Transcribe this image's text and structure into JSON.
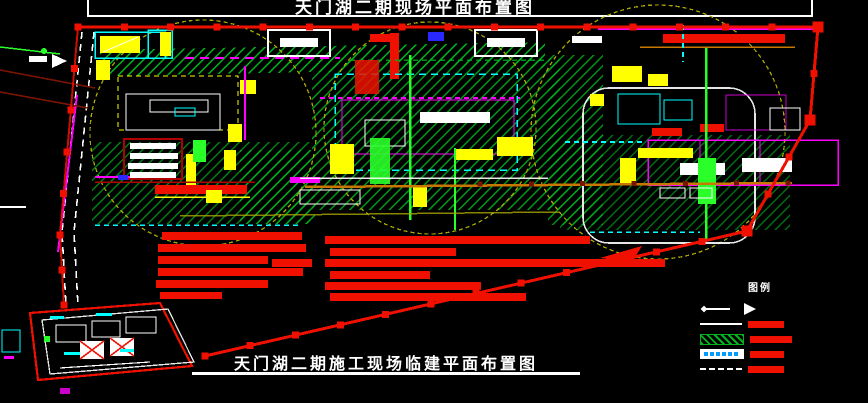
{
  "titles": {
    "top": "天门湖二期现场平面布置图",
    "bottom": "天门湖二期施工现场临建平面布置图"
  },
  "legend": {
    "label": "图例",
    "items": [
      {
        "symbol": "direction-arrow"
      },
      {
        "symbol": "solid-line",
        "swatch": "red-bar"
      },
      {
        "symbol": "green-hatch-area",
        "swatch": "red-bar"
      },
      {
        "symbol": "white-label-box",
        "swatch": "red-bar"
      },
      {
        "symbol": "dashed-line",
        "swatch": "red-bar"
      }
    ]
  },
  "palette": {
    "bg": "#000000",
    "red": "#f01000",
    "darkred": "#b00000",
    "maroon": "#781400",
    "yellow": "#ffff00",
    "olive": "#aaa800",
    "green": "#00b41e",
    "bgreen": "#2aff2a",
    "cyan": "#00ffff",
    "magenta": "#ff00ff",
    "white": "#ffffff",
    "orange": "#c87800",
    "blue": "#2828ff",
    "gray": "#cccccc"
  }
}
